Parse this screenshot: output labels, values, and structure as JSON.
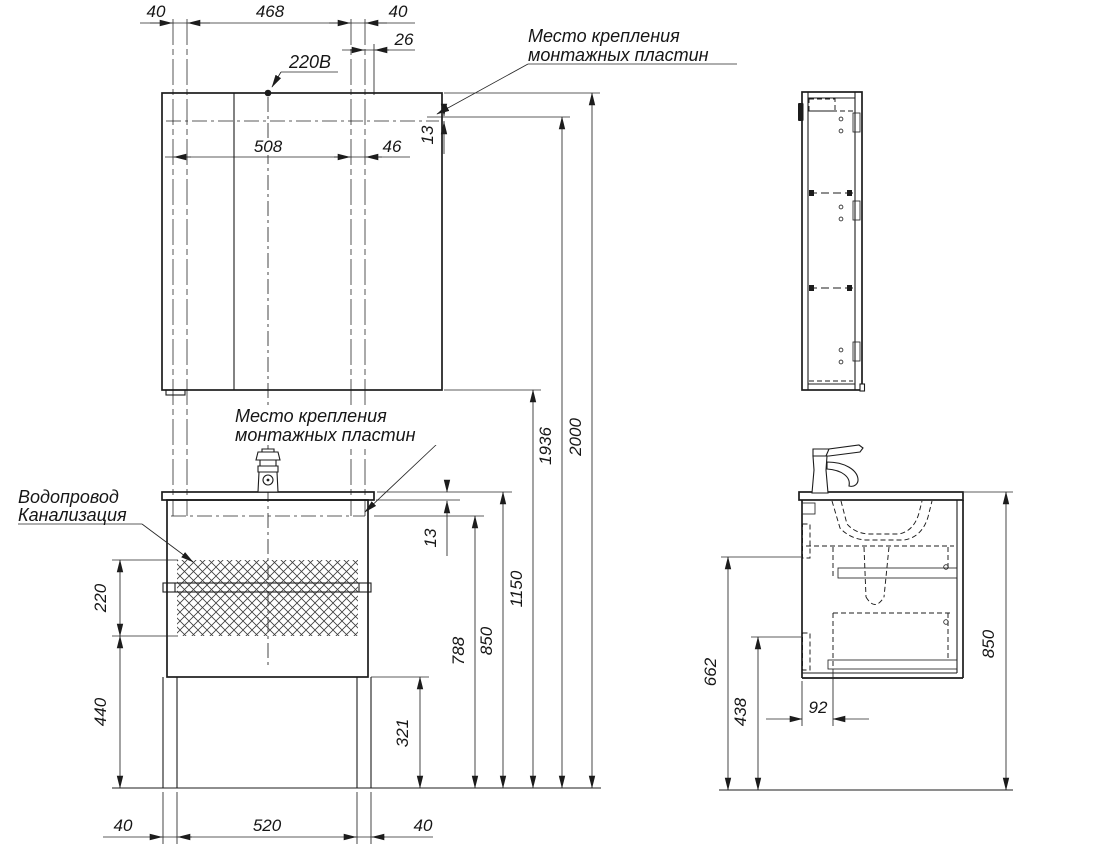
{
  "colors": {
    "line": "#1c1c1c",
    "background": "#ffffff"
  },
  "front": {
    "dims": {
      "top_left": "40",
      "top_span": "468",
      "top_right": "40",
      "plate_offset": "26",
      "mount_span": "508",
      "mount_side": "46",
      "plate_gap_top": "13",
      "plate_gap_mid": "13",
      "hatch_height": "220",
      "hatch_to_floor": "440",
      "plinth_height": "321",
      "h_mount": "788",
      "h_counter": "850",
      "h_mirror_bottom": "1150",
      "h_mirror_mount": "1936",
      "h_total": "2000",
      "base_left": "40",
      "base_span": "520",
      "base_right": "40"
    },
    "labels": {
      "power": "220В",
      "note_top": [
        "Место крепления",
        "монтажных пластин"
      ],
      "note_mid": [
        "Место крепления",
        "монтажных пластин"
      ],
      "plumbing": [
        "Водопровод",
        "Канализация"
      ]
    }
  },
  "side": {
    "dims": {
      "h_rail_upper": "662",
      "h_rail_lower": "438",
      "front_inset": "92",
      "h_counter": "850"
    }
  }
}
